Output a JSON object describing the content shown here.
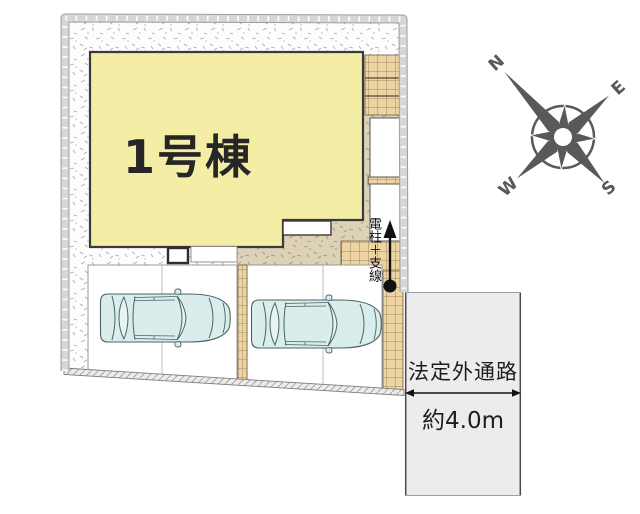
{
  "site_plan": {
    "building": {
      "label": "1号棟"
    },
    "utility_pole": {
      "label": "電柱＋支線"
    },
    "road": {
      "name": "法定外通路",
      "width": "約4.0m"
    },
    "compass": {
      "north": "N",
      "east": "E",
      "south": "S",
      "west": "W"
    },
    "colors": {
      "building_fill": "#f3eda5",
      "ground_fill": "#ddd2b8",
      "tile_fill": "#eed4a2",
      "road_fill": "#ececec",
      "car_fill": "#d9eeec",
      "compass": "#5a5858"
    }
  }
}
